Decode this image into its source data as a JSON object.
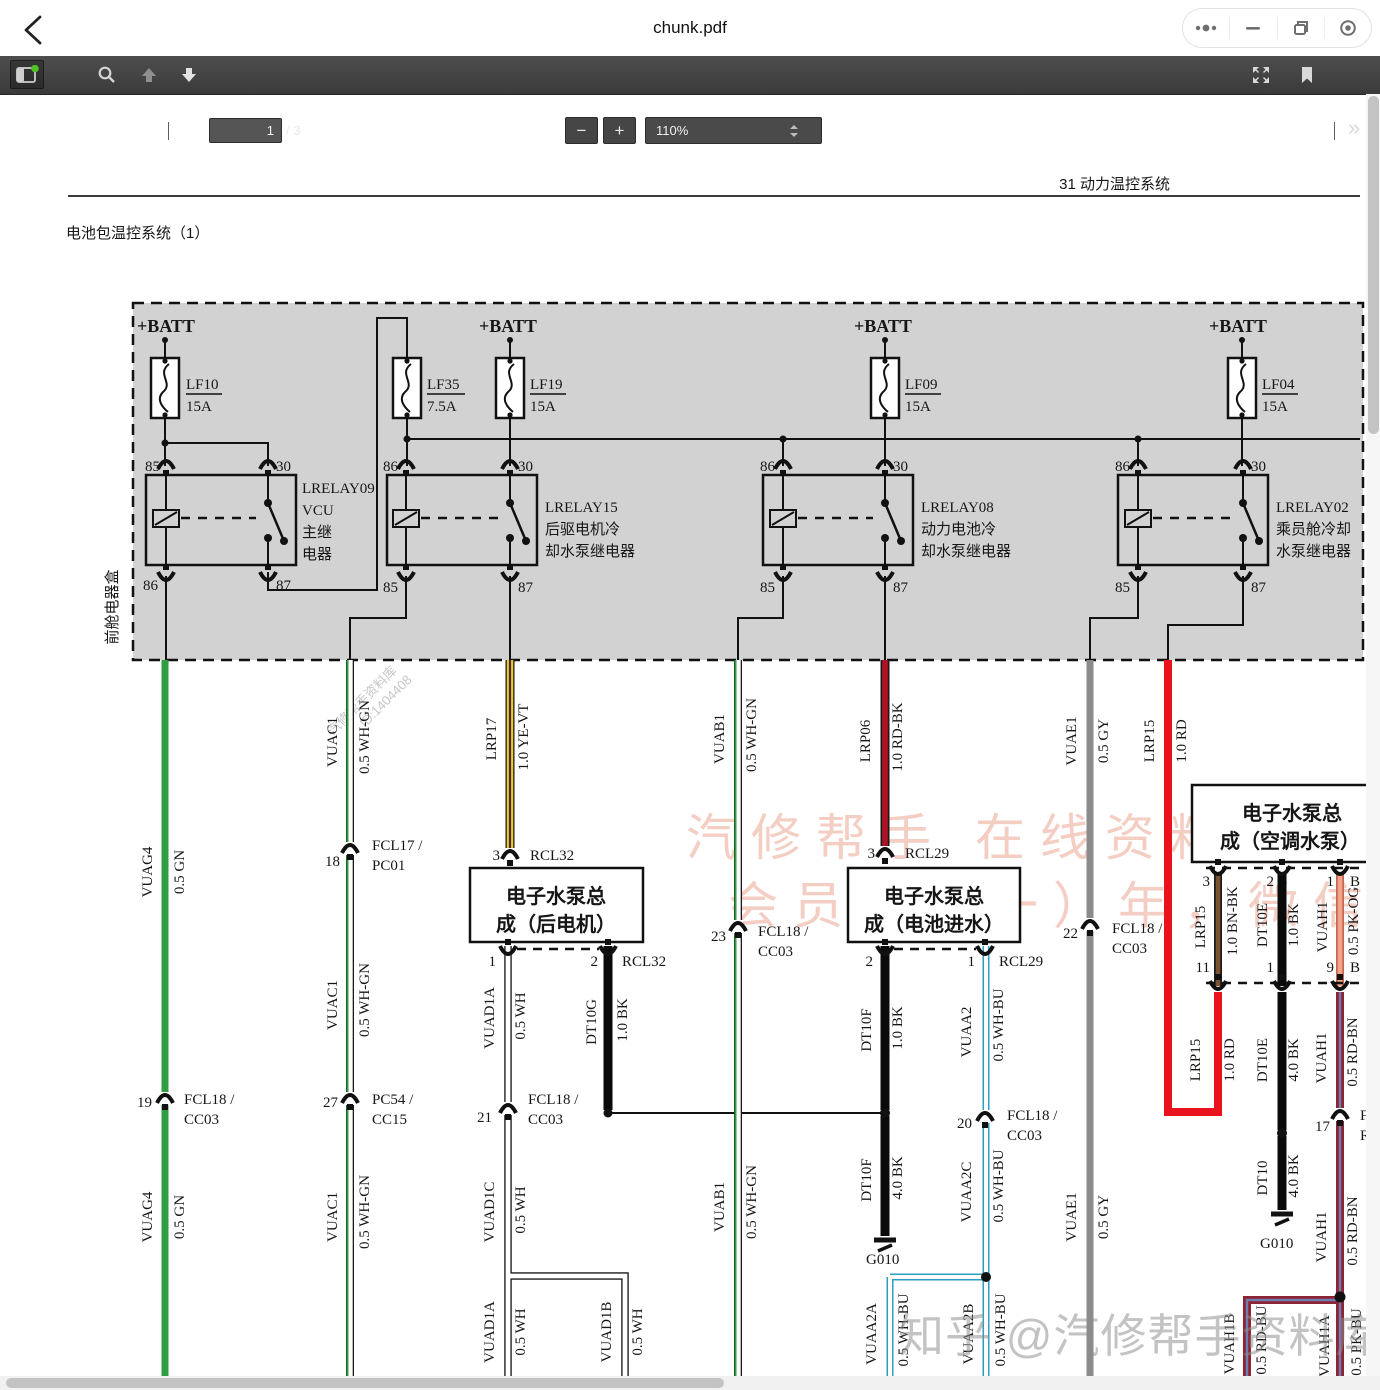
{
  "topbar": {
    "title": "chunk.pdf",
    "controls": [
      "more-icon",
      "minimize-icon",
      "restore-icon",
      "quit-circle-icon"
    ]
  },
  "toolbar": {
    "page_current": "1",
    "page_total": "/ 3",
    "zoom_level": "110%",
    "icons": [
      "sidebar-toggle",
      "search",
      "page-up",
      "page-down",
      "zoom-out",
      "zoom-in",
      "fullscreen",
      "bookmark",
      "more-tools"
    ],
    "zoom_out_label": "−",
    "zoom_in_label": "+",
    "more_tools_label": "»"
  },
  "colors": {
    "toolbar_bg": "#3f3f3f",
    "sidebar_badge_green": "#4fc122",
    "wire_green": "#2f9e43",
    "wire_yellow": "#f0cd1f",
    "wire_violet_stripe": "#46284a",
    "wire_red": "#e8131d",
    "wire_red_black": "#b01225",
    "wire_gray": "#8b8b8b",
    "wire_brown": "#7a5230",
    "wire_pink_orange": "#f2a38c",
    "wire_maroon": "#8e2433",
    "wire_blue_stripe": "#2e9dc4",
    "relay_box_fill": "#d2d2d2",
    "watermark_pink": "#f4cdc3"
  },
  "watermarks": {
    "diagonal_line1": "汽修帮手资料库",
    "diagonal_line2": "ID:1404408",
    "pink_line1": "汽修帮手 在线资料库",
    "pink_line2": "会员仅（一）年，微信",
    "zhihu": "知乎 @汽修帮手资料库"
  },
  "diagram": {
    "sheet_header": "31 动力温控系统",
    "sheet_title": "电池包温控系统（1）",
    "labels": [
      {
        "t": "31 动力温控系统",
        "x": 1170,
        "y": 189,
        "a": "e",
        "f": "sans",
        "s": 17
      },
      {
        "t": "电池包温控系统（1）",
        "x": 66,
        "y": 238,
        "f": "sans",
        "s": 23
      },
      {
        "t": "+BATT",
        "x": 137,
        "y": 332,
        "f": "serifb"
      },
      {
        "t": "+BATT",
        "x": 479,
        "y": 332,
        "f": "serifb"
      },
      {
        "t": "+BATT",
        "x": 854,
        "y": 332,
        "f": "serifb"
      },
      {
        "t": "+BATT",
        "x": 1209,
        "y": 332,
        "f": "serifb"
      },
      {
        "t": "LF10",
        "x": 186,
        "y": 389
      },
      {
        "t": "15A",
        "x": 186,
        "y": 411
      },
      {
        "t": "LF35",
        "x": 427,
        "y": 389
      },
      {
        "t": "7.5A",
        "x": 427,
        "y": 411
      },
      {
        "t": "LF19",
        "x": 530,
        "y": 389
      },
      {
        "t": "15A",
        "x": 530,
        "y": 411
      },
      {
        "t": "LF09",
        "x": 905,
        "y": 389
      },
      {
        "t": "15A",
        "x": 905,
        "y": 411
      },
      {
        "t": "LF04",
        "x": 1262,
        "y": 389
      },
      {
        "t": "15A",
        "x": 1262,
        "y": 411
      },
      {
        "t": "85",
        "x": 160,
        "y": 471,
        "a": "e"
      },
      {
        "t": "30",
        "x": 276,
        "y": 471
      },
      {
        "t": "86",
        "x": 158,
        "y": 590,
        "a": "e"
      },
      {
        "t": "87",
        "x": 276,
        "y": 590
      },
      {
        "t": "86",
        "x": 398,
        "y": 471,
        "a": "e"
      },
      {
        "t": "30",
        "x": 518,
        "y": 471
      },
      {
        "t": "85",
        "x": 398,
        "y": 592,
        "a": "e"
      },
      {
        "t": "87",
        "x": 518,
        "y": 592
      },
      {
        "t": "86",
        "x": 775,
        "y": 471,
        "a": "e"
      },
      {
        "t": "30",
        "x": 893,
        "y": 471
      },
      {
        "t": "85",
        "x": 775,
        "y": 592,
        "a": "e"
      },
      {
        "t": "87",
        "x": 893,
        "y": 592
      },
      {
        "t": "86",
        "x": 1130,
        "y": 471,
        "a": "e"
      },
      {
        "t": "30",
        "x": 1251,
        "y": 471
      },
      {
        "t": "85",
        "x": 1130,
        "y": 592,
        "a": "e"
      },
      {
        "t": "87",
        "x": 1251,
        "y": 592
      },
      {
        "t": "LRELAY09",
        "x": 302,
        "y": 493
      },
      {
        "t": "VCU",
        "x": 302,
        "y": 515
      },
      {
        "t": "主继",
        "x": 302,
        "y": 537,
        "f": "sans"
      },
      {
        "t": "电器",
        "x": 302,
        "y": 559,
        "f": "sans"
      },
      {
        "t": "LRELAY15",
        "x": 545,
        "y": 512
      },
      {
        "t": "后驱电机冷",
        "x": 545,
        "y": 534,
        "f": "sans"
      },
      {
        "t": "却水泵继电器",
        "x": 545,
        "y": 556,
        "f": "sans"
      },
      {
        "t": "LRELAY08",
        "x": 921,
        "y": 512
      },
      {
        "t": "动力电池冷",
        "x": 921,
        "y": 534,
        "f": "sans"
      },
      {
        "t": "却水泵继电器",
        "x": 921,
        "y": 556,
        "f": "sans"
      },
      {
        "t": "LRELAY02",
        "x": 1276,
        "y": 512
      },
      {
        "t": "乘员舱冷却",
        "x": 1276,
        "y": 534,
        "f": "sans"
      },
      {
        "t": "水泵继电器",
        "x": 1276,
        "y": 556,
        "f": "sans"
      },
      {
        "t": "前舱电器盒",
        "x": 117,
        "y": 607,
        "r": -90,
        "a": "m",
        "f": "sans",
        "s": 16
      },
      {
        "t": "电子水泵总",
        "x": 556,
        "y": 903,
        "a": "m",
        "f": "sansb"
      },
      {
        "t": "成（后电机）",
        "x": 556,
        "y": 931,
        "a": "m",
        "f": "sansb"
      },
      {
        "t": "电子水泵总",
        "x": 934,
        "y": 903,
        "a": "m",
        "f": "sansb"
      },
      {
        "t": "成（电池进水）",
        "x": 934,
        "y": 931,
        "a": "m",
        "f": "sansb"
      },
      {
        "t": "电子水泵总",
        "x": 1292,
        "y": 820,
        "a": "m",
        "f": "sansb"
      },
      {
        "t": "成（空调水泵）",
        "x": 1290,
        "y": 848,
        "a": "m",
        "f": "sansb"
      },
      {
        "t": "VUAG4",
        "x": 152,
        "y": 872,
        "r": -90,
        "a": "m"
      },
      {
        "t": "0.5 GN",
        "x": 184,
        "y": 872,
        "r": -90,
        "a": "m"
      },
      {
        "t": "VUAC1",
        "x": 337,
        "y": 742,
        "r": -90,
        "a": "m"
      },
      {
        "t": "0.5 WH-GN",
        "x": 369,
        "y": 737,
        "r": -90,
        "a": "m"
      },
      {
        "t": "LRP17",
        "x": 496,
        "y": 739,
        "r": -90,
        "a": "m"
      },
      {
        "t": "1.0 YE-VT",
        "x": 528,
        "y": 737,
        "r": -90,
        "a": "m"
      },
      {
        "t": "VUAB1",
        "x": 724,
        "y": 739,
        "r": -90,
        "a": "m"
      },
      {
        "t": "0.5 WH-GN",
        "x": 756,
        "y": 735,
        "r": -90,
        "a": "m"
      },
      {
        "t": "LRP06",
        "x": 870,
        "y": 741,
        "r": -90,
        "a": "m"
      },
      {
        "t": "1.0 RD-BK",
        "x": 902,
        "y": 737,
        "r": -90,
        "a": "m"
      },
      {
        "t": "VUAE1",
        "x": 1076,
        "y": 741,
        "r": -90,
        "a": "m"
      },
      {
        "t": "0.5 GY",
        "x": 1108,
        "y": 741,
        "r": -90,
        "a": "m"
      },
      {
        "t": "LRP15",
        "x": 1154,
        "y": 741,
        "r": -90,
        "a": "m"
      },
      {
        "t": "1.0 RD",
        "x": 1186,
        "y": 741,
        "r": -90,
        "a": "m"
      },
      {
        "t": "VUAC1",
        "x": 337,
        "y": 1005,
        "r": -90,
        "a": "m"
      },
      {
        "t": "0.5 WH-GN",
        "x": 369,
        "y": 1000,
        "r": -90,
        "a": "m"
      },
      {
        "t": "VUAD1A",
        "x": 494,
        "y": 1018,
        "r": -90,
        "a": "m"
      },
      {
        "t": "0.5 WH",
        "x": 525,
        "y": 1016,
        "r": -90,
        "a": "m"
      },
      {
        "t": "DT10G",
        "x": 596,
        "y": 1022,
        "r": -90,
        "a": "m"
      },
      {
        "t": "1.0 BK",
        "x": 627,
        "y": 1020,
        "r": -90,
        "a": "m"
      },
      {
        "t": "DT10F",
        "x": 871,
        "y": 1030,
        "r": -90,
        "a": "m"
      },
      {
        "t": "1.0 BK",
        "x": 902,
        "y": 1028,
        "r": -90,
        "a": "m"
      },
      {
        "t": "VUAA2",
        "x": 971,
        "y": 1032,
        "r": -90,
        "a": "m"
      },
      {
        "t": "0.5 WH-BU",
        "x": 1003,
        "y": 1025,
        "r": -90,
        "a": "m"
      },
      {
        "t": "LRP15",
        "x": 1205,
        "y": 927,
        "r": -90,
        "a": "m"
      },
      {
        "t": "1.0 BN-BK",
        "x": 1237,
        "y": 921,
        "r": -90,
        "a": "m"
      },
      {
        "t": "DT10E",
        "x": 1267,
        "y": 925,
        "r": -90,
        "a": "m"
      },
      {
        "t": "1.0 BK",
        "x": 1298,
        "y": 925,
        "r": -90,
        "a": "m"
      },
      {
        "t": "VUAH1",
        "x": 1327,
        "y": 927,
        "r": -90,
        "a": "m"
      },
      {
        "t": "0.5 PK-OG",
        "x": 1358,
        "y": 921,
        "r": -90,
        "a": "m"
      },
      {
        "t": "LRP15",
        "x": 1200,
        "y": 1060,
        "r": -90,
        "a": "m"
      },
      {
        "t": "1.0 RD",
        "x": 1234,
        "y": 1060,
        "r": -90,
        "a": "m"
      },
      {
        "t": "DT10E",
        "x": 1267,
        "y": 1060,
        "r": -90,
        "a": "m"
      },
      {
        "t": "4.0 BK",
        "x": 1298,
        "y": 1060,
        "r": -90,
        "a": "m"
      },
      {
        "t": "VUAH1",
        "x": 1326,
        "y": 1058,
        "r": -90,
        "a": "m"
      },
      {
        "t": "0.5 RD-BN",
        "x": 1357,
        "y": 1052,
        "r": -90,
        "a": "m"
      },
      {
        "t": "VUAG4",
        "x": 152,
        "y": 1217,
        "r": -90,
        "a": "m"
      },
      {
        "t": "0.5 GN",
        "x": 184,
        "y": 1217,
        "r": -90,
        "a": "m"
      },
      {
        "t": "VUAC1",
        "x": 337,
        "y": 1217,
        "r": -90,
        "a": "m"
      },
      {
        "t": "0.5 WH-GN",
        "x": 369,
        "y": 1212,
        "r": -90,
        "a": "m"
      },
      {
        "t": "VUAD1C",
        "x": 494,
        "y": 1212,
        "r": -90,
        "a": "m"
      },
      {
        "t": "0.5 WH",
        "x": 525,
        "y": 1210,
        "r": -90,
        "a": "m"
      },
      {
        "t": "VUAB1",
        "x": 724,
        "y": 1207,
        "r": -90,
        "a": "m"
      },
      {
        "t": "0.5 WH-GN",
        "x": 756,
        "y": 1202,
        "r": -90,
        "a": "m"
      },
      {
        "t": "DT10F",
        "x": 871,
        "y": 1180,
        "r": -90,
        "a": "m"
      },
      {
        "t": "4.0 BK",
        "x": 902,
        "y": 1178,
        "r": -90,
        "a": "m"
      },
      {
        "t": "VUAA2C",
        "x": 971,
        "y": 1192,
        "r": -90,
        "a": "m"
      },
      {
        "t": "0.5 WH-BU",
        "x": 1003,
        "y": 1186,
        "r": -90,
        "a": "m"
      },
      {
        "t": "VUAE1",
        "x": 1076,
        "y": 1217,
        "r": -90,
        "a": "m"
      },
      {
        "t": "0.5 GY",
        "x": 1108,
        "y": 1217,
        "r": -90,
        "a": "m"
      },
      {
        "t": "DT10",
        "x": 1267,
        "y": 1178,
        "r": -90,
        "a": "m"
      },
      {
        "t": "4.0 BK",
        "x": 1298,
        "y": 1176,
        "r": -90,
        "a": "m"
      },
      {
        "t": "VUAH1",
        "x": 1326,
        "y": 1237,
        "r": -90,
        "a": "m"
      },
      {
        "t": "0.5 RD-BN",
        "x": 1357,
        "y": 1231,
        "r": -90,
        "a": "m"
      },
      {
        "t": "VUAD1A",
        "x": 494,
        "y": 1332,
        "r": -90,
        "a": "m"
      },
      {
        "t": "0.5 WH",
        "x": 525,
        "y": 1332,
        "r": -90,
        "a": "m"
      },
      {
        "t": "VUAD1B",
        "x": 611,
        "y": 1332,
        "r": -90,
        "a": "m"
      },
      {
        "t": "0.5 WH",
        "x": 642,
        "y": 1332,
        "r": -90,
        "a": "m"
      },
      {
        "t": "VUAA2A",
        "x": 876,
        "y": 1334,
        "r": -90,
        "a": "m"
      },
      {
        "t": "0.5 WH-BU",
        "x": 908,
        "y": 1330,
        "r": -90,
        "a": "m"
      },
      {
        "t": "VUAA2B",
        "x": 973,
        "y": 1334,
        "r": -90,
        "a": "m"
      },
      {
        "t": "0.5 WH-BU",
        "x": 1005,
        "y": 1330,
        "r": -90,
        "a": "m"
      },
      {
        "t": "VUAH1B",
        "x": 1234,
        "y": 1344,
        "r": -90,
        "a": "m"
      },
      {
        "t": "0.5 RD-BU",
        "x": 1266,
        "y": 1340,
        "r": -90,
        "a": "m"
      },
      {
        "t": "VUAH1A",
        "x": 1329,
        "y": 1346,
        "r": -90,
        "a": "m"
      },
      {
        "t": "0.5 PK-BU",
        "x": 1361,
        "y": 1342,
        "r": -90,
        "a": "m"
      },
      {
        "t": "18",
        "x": 340,
        "y": 866,
        "a": "e"
      },
      {
        "t": "FCL17 /",
        "x": 372,
        "y": 850
      },
      {
        "t": "PC01",
        "x": 372,
        "y": 870
      },
      {
        "t": "3",
        "x": 500,
        "y": 860,
        "a": "e"
      },
      {
        "t": "RCL32",
        "x": 530,
        "y": 860
      },
      {
        "t": "19",
        "x": 152,
        "y": 1107,
        "a": "e"
      },
      {
        "t": "FCL18 /",
        "x": 184,
        "y": 1104
      },
      {
        "t": "CC03",
        "x": 184,
        "y": 1124
      },
      {
        "t": "27",
        "x": 338,
        "y": 1107,
        "a": "e"
      },
      {
        "t": "PC54 /",
        "x": 372,
        "y": 1104
      },
      {
        "t": "CC15",
        "x": 372,
        "y": 1124
      },
      {
        "t": "21",
        "x": 492,
        "y": 1122,
        "a": "e"
      },
      {
        "t": "FCL18 /",
        "x": 528,
        "y": 1104
      },
      {
        "t": "CC03",
        "x": 528,
        "y": 1124
      },
      {
        "t": "23",
        "x": 726,
        "y": 941,
        "a": "e"
      },
      {
        "t": "FCL18 /",
        "x": 758,
        "y": 936
      },
      {
        "t": "CC03",
        "x": 758,
        "y": 956
      },
      {
        "t": "3",
        "x": 875,
        "y": 858,
        "a": "e"
      },
      {
        "t": "RCL29",
        "x": 905,
        "y": 858
      },
      {
        "t": "20",
        "x": 972,
        "y": 1128,
        "a": "e"
      },
      {
        "t": "FCL18 /",
        "x": 1007,
        "y": 1120
      },
      {
        "t": "CC03",
        "x": 1007,
        "y": 1140
      },
      {
        "t": "22",
        "x": 1078,
        "y": 938,
        "a": "e"
      },
      {
        "t": "FCL18 /",
        "x": 1112,
        "y": 933
      },
      {
        "t": "CC03",
        "x": 1112,
        "y": 953
      },
      {
        "t": "17",
        "x": 1330,
        "y": 1131,
        "a": "e"
      },
      {
        "t": "F",
        "x": 1360,
        "y": 1120
      },
      {
        "t": "R",
        "x": 1360,
        "y": 1140
      },
      {
        "t": "1",
        "x": 496,
        "y": 966,
        "a": "e"
      },
      {
        "t": "2",
        "x": 598,
        "y": 966,
        "a": "e"
      },
      {
        "t": "RCL32",
        "x": 622,
        "y": 966
      },
      {
        "t": "2",
        "x": 873,
        "y": 966,
        "a": "e"
      },
      {
        "t": "1",
        "x": 975,
        "y": 966,
        "a": "e"
      },
      {
        "t": "RCL29",
        "x": 999,
        "y": 966
      },
      {
        "t": "3",
        "x": 1210,
        "y": 886,
        "a": "e"
      },
      {
        "t": "2",
        "x": 1274,
        "y": 886,
        "a": "e"
      },
      {
        "t": "1",
        "x": 1334,
        "y": 886,
        "a": "e"
      },
      {
        "t": "B",
        "x": 1350,
        "y": 886
      },
      {
        "t": "11",
        "x": 1210,
        "y": 972,
        "a": "e"
      },
      {
        "t": "1",
        "x": 1274,
        "y": 972,
        "a": "e"
      },
      {
        "t": "9",
        "x": 1334,
        "y": 972,
        "a": "e"
      },
      {
        "t": "B",
        "x": 1350,
        "y": 972
      },
      {
        "t": "G010",
        "x": 866,
        "y": 1264
      },
      {
        "t": "G010",
        "x": 1260,
        "y": 1248
      }
    ]
  }
}
